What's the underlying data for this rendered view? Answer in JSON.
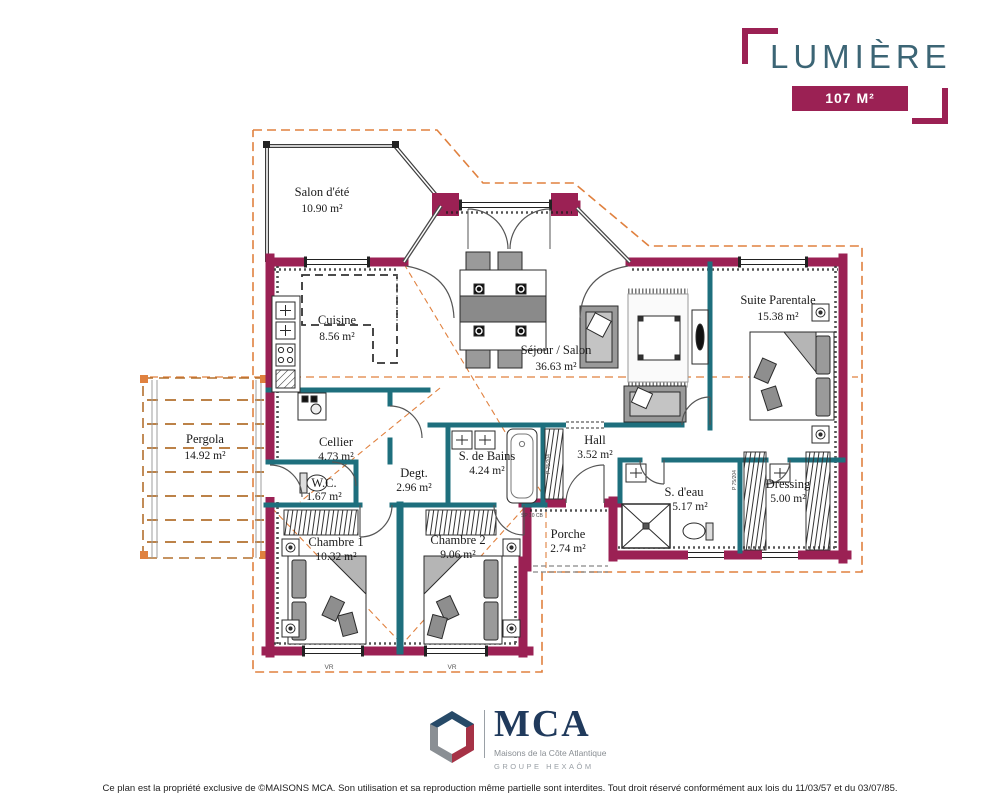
{
  "header": {
    "title": "LUMIÈRE",
    "area_badge": "107 M²"
  },
  "rooms": [
    {
      "name": "Salon d'été",
      "area": "10.90 m²"
    },
    {
      "name": "Cuisine",
      "area": "8.56 m²"
    },
    {
      "name": "Séjour / Salon",
      "area": "36.63 m²"
    },
    {
      "name": "Suite Parentale",
      "area": "15.38 m²"
    },
    {
      "name": "Pergola",
      "area": "14.92 m²"
    },
    {
      "name": "Cellier",
      "area": "4.73 m²"
    },
    {
      "name": "W.C.",
      "area": "1.67 m²"
    },
    {
      "name": "Degt.",
      "area": "2.96 m²"
    },
    {
      "name": "S. de Bains",
      "area": "4.24 m²"
    },
    {
      "name": "Hall",
      "area": "3.52 m²"
    },
    {
      "name": "S. d'eau",
      "area": "5.17 m²"
    },
    {
      "name": "Dressing",
      "area": "5.00 m²"
    },
    {
      "name": "Chambre 1",
      "area": "10.32 m²"
    },
    {
      "name": "Chambre 2",
      "area": "9.06 m²"
    },
    {
      "name": "Porche",
      "area": "2.74 m²"
    }
  ],
  "annotations": {
    "porch_code": "SP 10 CB",
    "window_shutter_left": "VR",
    "window_shutter_right": "VR",
    "door_code_1": "P 75/204",
    "door_code_2": "P 75/204"
  },
  "logo": {
    "brand": "MCA",
    "tagline": "Maisons de la Côte Atlantique",
    "group": "GROUPE HEXAÔM"
  },
  "footer": {
    "text": "Ce plan est la propriété exclusive de ©MAISONS MCA. Son utilisation et sa reproduction même partielle sont interdites. Tout droit réservé conformément aux lois du 11/03/57 et du 03/07/85."
  },
  "colors": {
    "exterior_wall": "#9b2154",
    "interior_wall": "#1e6f7d",
    "roof_overhang": "#e0813f",
    "title_text": "#3c6575",
    "logo_navy": "#203a5c",
    "logo_gray": "#9aa0a6",
    "logo_red": "#a63246"
  }
}
